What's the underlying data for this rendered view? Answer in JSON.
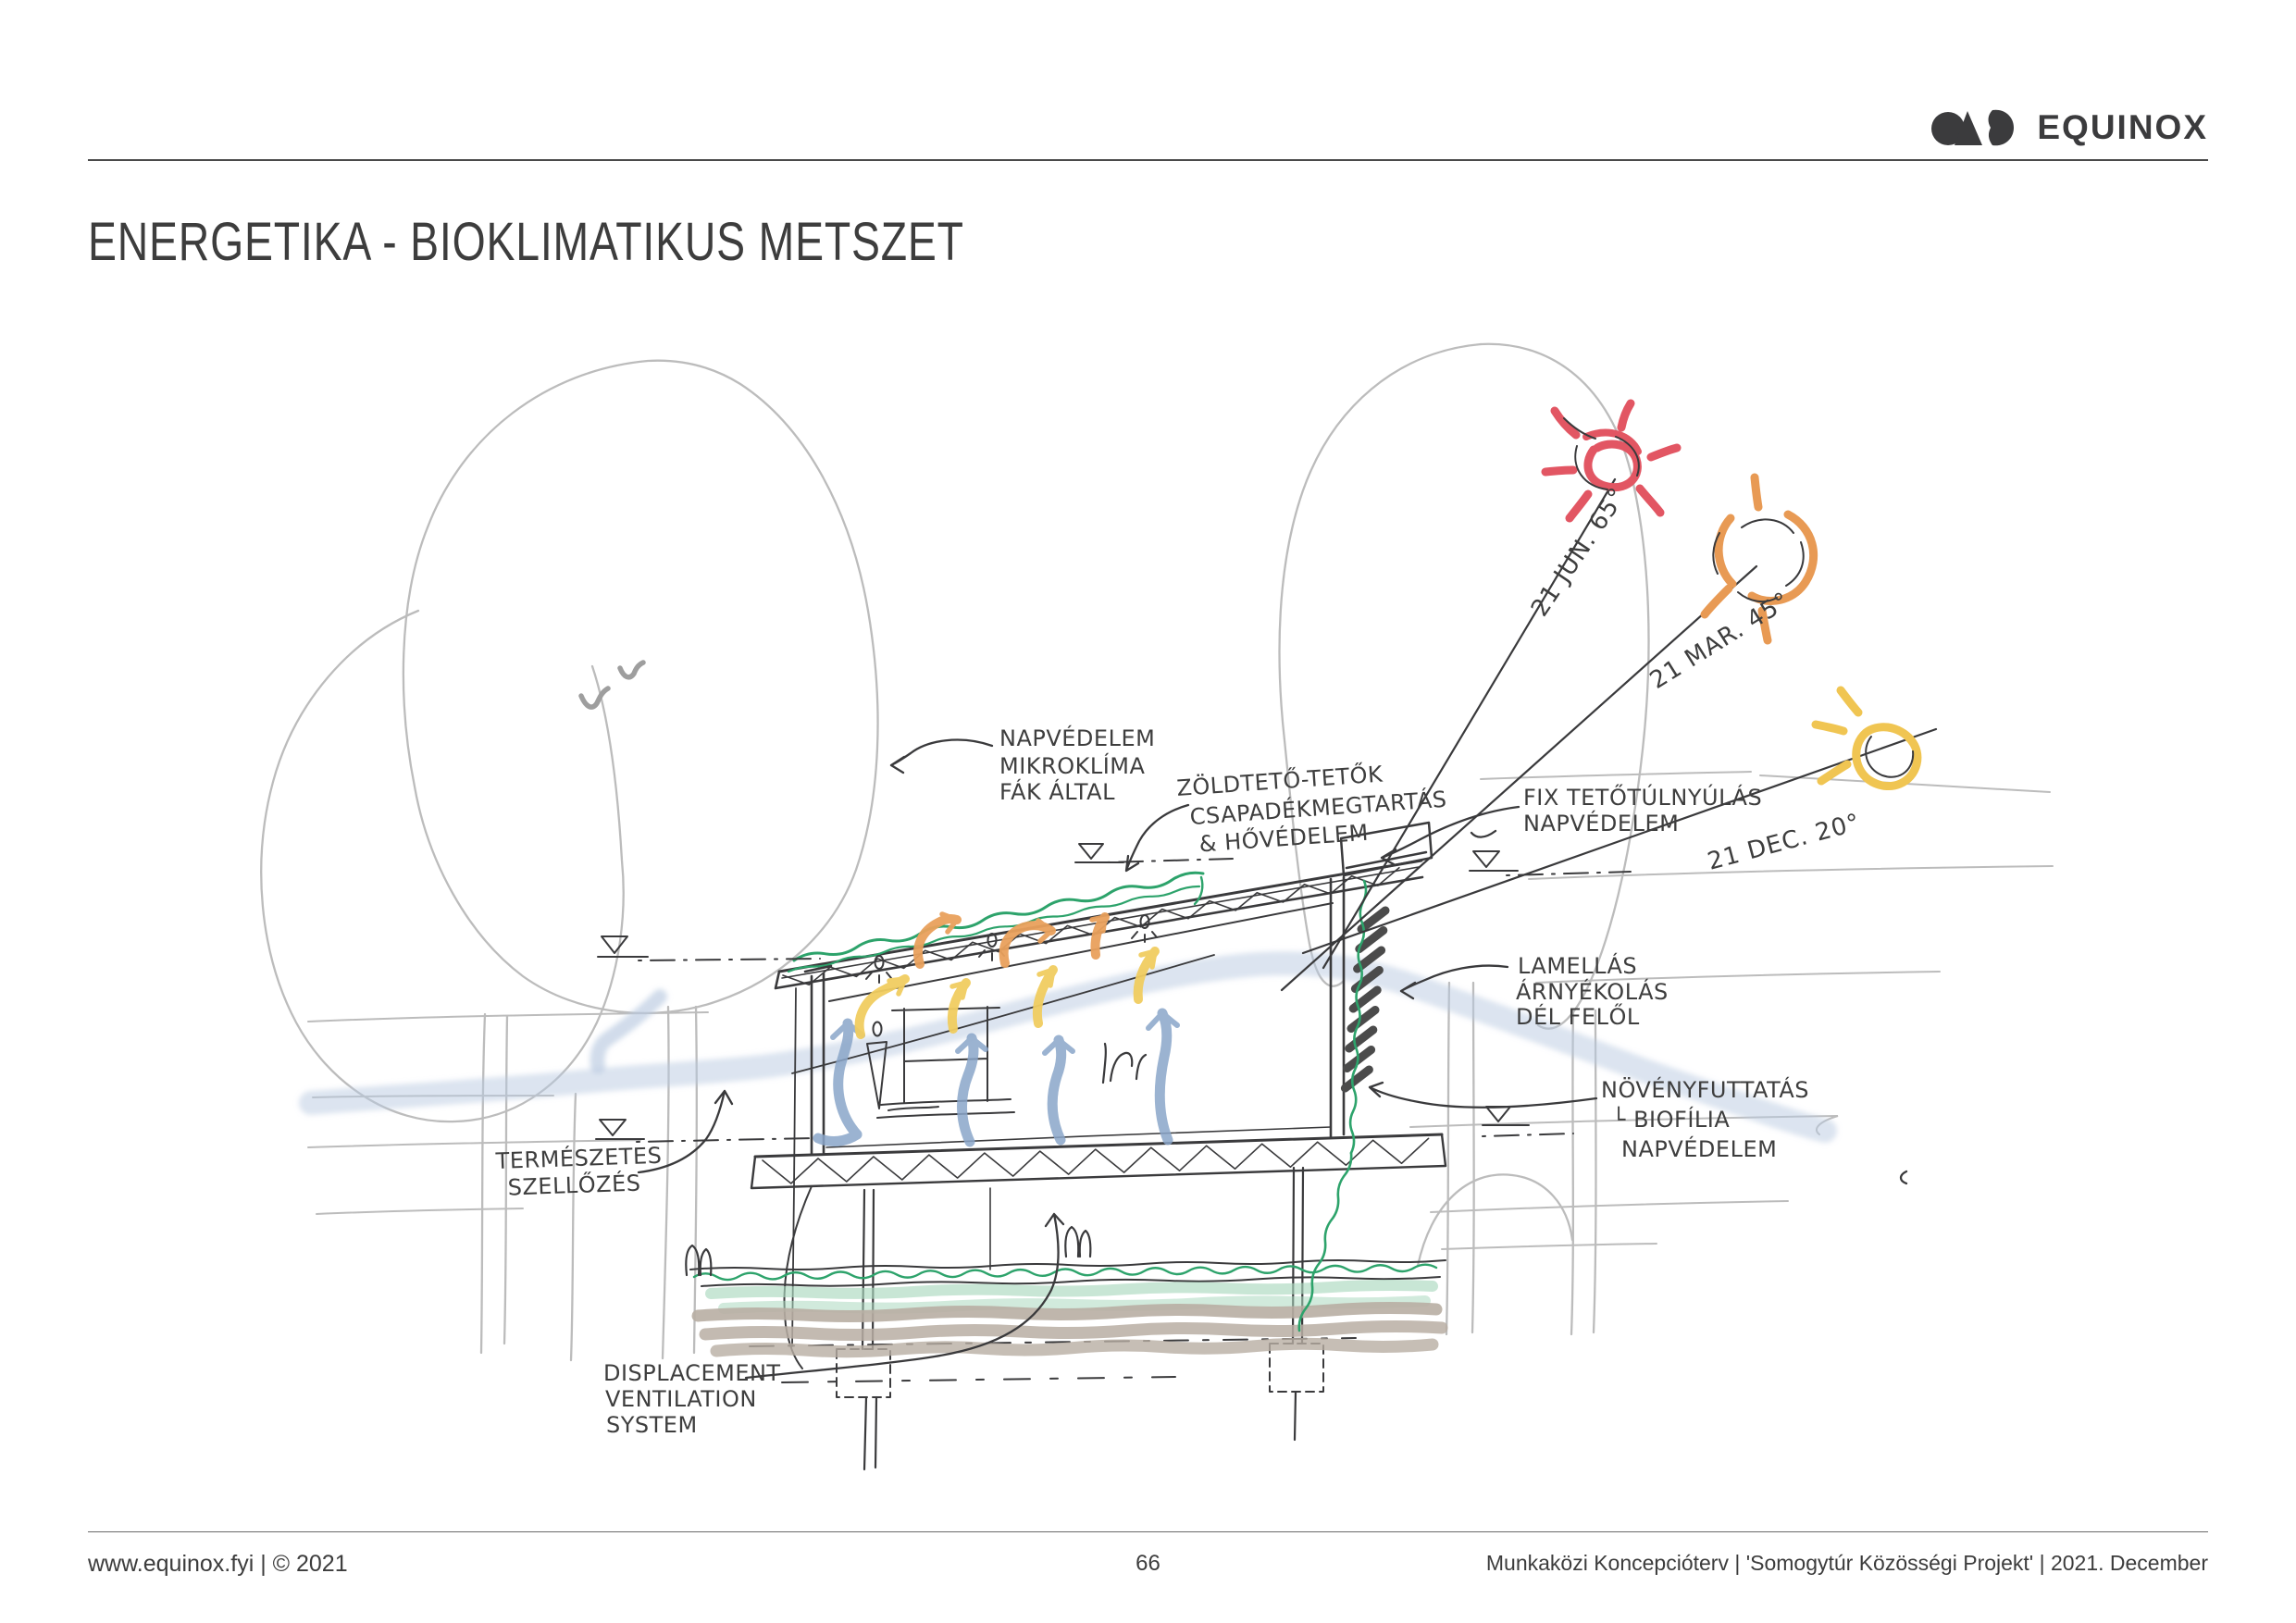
{
  "header": {
    "brand": "EQUINOX"
  },
  "title": "ENERGETIKA - BIOKLIMATIKUS METSZET",
  "footer": {
    "left": "www.equinox.fyi | © 2021",
    "page": "66",
    "right": "Munkaközi Koncepcióterv | 'Somogytúr Közösségi Projekt' | 2021. December"
  },
  "sketch": {
    "labels": {
      "trees": [
        "NAPVÉDELEM",
        "MIKROKLÍMA",
        "FÁK ÁLTAL"
      ],
      "green_roof": [
        "ZÖLDTETŐ-TETŐK",
        "CSAPADÉKMEGTARTÁS",
        "& HŐVÉDELEM"
      ],
      "overhang": [
        "FIX TETŐTÚLNYÚLÁS",
        "NAPVÉDELEM"
      ],
      "lamella": [
        "LAMELLÁS",
        "ÁRNYÉKOLÁS",
        "DÉL FELŐL"
      ],
      "green_facade": [
        "NÖVÉNYFUTTATÁS",
        "└ BIOFÍLIA",
        "NAPVÉDELEM"
      ],
      "natural_vent": [
        "TERMÉSZETES",
        "SZELLŐZÉS"
      ],
      "displacement": [
        "DISPLACEMENT",
        "VENTILATION",
        "SYSTEM"
      ],
      "sun_summer": "21 JUN. 65°",
      "sun_spring": "21 MAR. 45°",
      "sun_winter": "21 DEC. 20°"
    },
    "colors": {
      "ink": "#3a3a3c",
      "tree": "#bcbcbc",
      "green": "#2da36b",
      "green_soft": "#abd9bf",
      "soil": "#b8aea3",
      "air_cool": "#8aa6c9",
      "air_cool_soft": "#b9c9e1",
      "air_warm": "#f1cd60",
      "air_hot": "#e9a15c",
      "sun_summer": "#e25663",
      "sun_equinox": "#e89a54",
      "sun_winter": "#f0c552"
    }
  }
}
